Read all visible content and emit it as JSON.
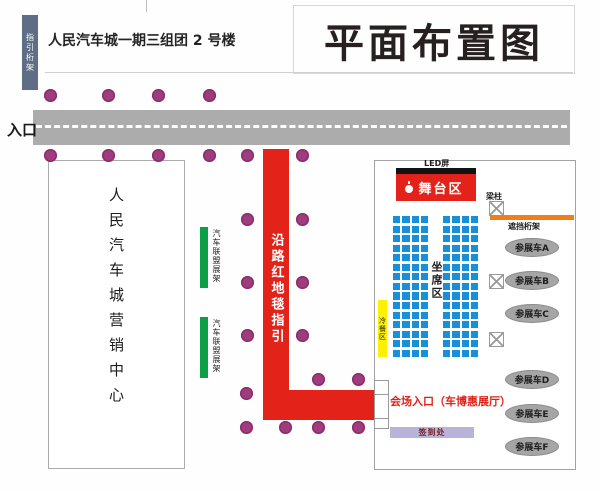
{
  "header": {
    "guide_truss_label": "指引桁架",
    "building_label": "人民汽车城一期三组团 2 号楼",
    "title": "平面布置图"
  },
  "road": {
    "entrance_label": "入口"
  },
  "carpet": {
    "label": "沿路红地毯指引"
  },
  "marketing_center": {
    "label": "人民汽车城营销中心"
  },
  "alliance_racks": [
    {
      "label": "汽车联盟展架"
    },
    {
      "label": "汽车联盟展架"
    }
  ],
  "venue": {
    "led_label": "LED屏",
    "stage_label": "舞台区",
    "pillar_label": "梁柱",
    "truss_label": "遮挡桁架",
    "seating_label": "坐席区",
    "buffet_label": "冷餐区",
    "entrance_label": "会场入口（车博惠展厅）",
    "signin_label": "签到处",
    "exhibit_cars": [
      "参展车A",
      "参展车B",
      "参展车C",
      "参展车D",
      "参展车E",
      "参展车F"
    ]
  },
  "colors": {
    "carpet_red": "#e3231a",
    "stage_red": "#e3231a",
    "dot_purple": "#9e3c7d",
    "road_gray": "#acacac",
    "rack_green": "#0c9f45",
    "truss_orange": "#ef8018",
    "buffet_yellow": "#fdf000",
    "seat_blue": "#1a8fd9",
    "signin_lavender": "#b7b4d9",
    "guide_truss_slate": "#5f6e84"
  }
}
